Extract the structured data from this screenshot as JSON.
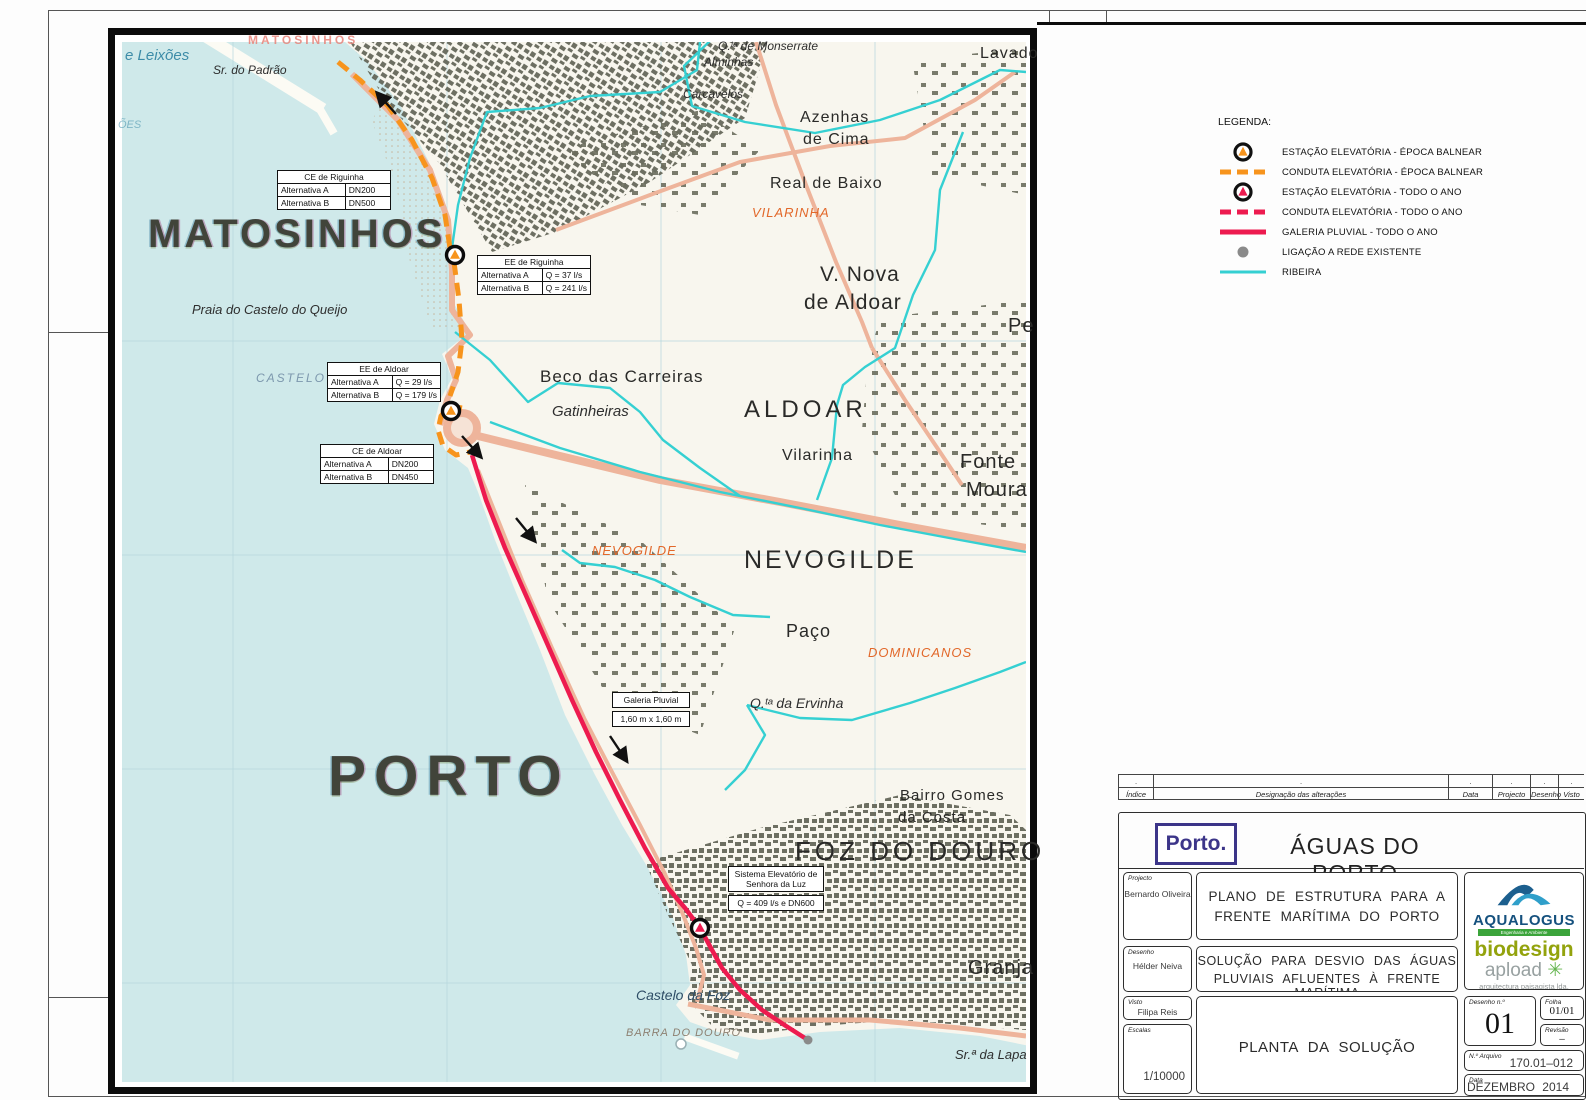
{
  "colors": {
    "orange": "#F7941D",
    "pink": "#ED1B4F",
    "cyan": "#35D0D2",
    "gray_dot": "#8A8A8A",
    "sea": "#cfe9ea",
    "land": "#f8f6ee",
    "navy_logo": "#3c3589"
  },
  "legend": {
    "title": "LEGENDA:",
    "items": [
      {
        "type": "station",
        "color": "#F7941D",
        "icon": "pump-station-seasonal",
        "label": "ESTAÇÃO ELEVATÓRIA - ÉPOCA BALNEAR"
      },
      {
        "type": "dash",
        "color": "#F7941D",
        "icon": "pressure-main-seasonal",
        "label": "CONDUTA  ELEVATÓRIA - ÉPOCA BALNEAR"
      },
      {
        "type": "station",
        "color": "#ED1B4F",
        "icon": "pump-station-allyear",
        "label": "ESTAÇÃO ELEVATÓRIA - TODO O ANO"
      },
      {
        "type": "dash",
        "color": "#ED1B4F",
        "icon": "pressure-main-allyear",
        "label": "CONDUTA  ELEVATÓRIA - TODO O ANO"
      },
      {
        "type": "solid",
        "color": "#ED1B4F",
        "icon": "storm-gallery",
        "label": "GALERIA PLUVIAL - TODO O ANO"
      },
      {
        "type": "dot",
        "color": "#8A8A8A",
        "icon": "existing-network-connection",
        "label": "LIGAÇÃO A REDE EXISTENTE"
      },
      {
        "type": "solid",
        "color": "#35D0D2",
        "icon": "stream",
        "label": "RIBEIRA"
      }
    ]
  },
  "map": {
    "labels": [
      {
        "t": "e Leixões",
        "x": 125,
        "y": 48,
        "s": 15,
        "c": "m-sea"
      },
      {
        "t": "ÕES",
        "x": 118,
        "y": 120,
        "s": 11,
        "c": "m-sea m-dim"
      },
      {
        "t": "Sr. do Padrão",
        "x": 213,
        "y": 64,
        "s": 12,
        "c": "m-it"
      },
      {
        "t": "MATOSINHOS",
        "x": 248,
        "y": 34,
        "s": 12,
        "c": "m-red"
      },
      {
        "t": "MATOSINHOS",
        "x": 148,
        "y": 214,
        "s": 40,
        "c": "m-big sp3"
      },
      {
        "t": "Praia do Castelo do Queijo",
        "x": 192,
        "y": 303,
        "s": 13,
        "c": "m-it"
      },
      {
        "t": "CASTELO",
        "x": 256,
        "y": 372,
        "s": 12,
        "c": "m-bluecaps"
      },
      {
        "t": "PORTO",
        "x": 328,
        "y": 748,
        "s": 57,
        "c": "m-big sp8"
      },
      {
        "t": "Q.ᵗᵃ de Monserrate",
        "x": 718,
        "y": 40,
        "s": 12,
        "c": "m-it"
      },
      {
        "t": "Alminhas",
        "x": 704,
        "y": 56,
        "s": 12,
        "c": "m-it"
      },
      {
        "t": "Carcavelos",
        "x": 683,
        "y": 88,
        "s": 12,
        "c": "m-it"
      },
      {
        "t": "Azenhas",
        "x": 800,
        "y": 110,
        "s": 16,
        "c": "m-town"
      },
      {
        "t": "de Cima",
        "x": 803,
        "y": 132,
        "s": 16,
        "c": "m-town"
      },
      {
        "t": "Real de Baixo",
        "x": 770,
        "y": 176,
        "s": 16,
        "c": "m-town"
      },
      {
        "t": "VILARINHA",
        "x": 752,
        "y": 206,
        "s": 13,
        "c": "m-or"
      },
      {
        "t": "Lavado",
        "x": 980,
        "y": 46,
        "s": 16,
        "c": "m-town"
      },
      {
        "t": "V. Nova",
        "x": 820,
        "y": 264,
        "s": 21,
        "c": "m-town"
      },
      {
        "t": "de Aldoar",
        "x": 804,
        "y": 292,
        "s": 21,
        "c": "m-town"
      },
      {
        "t": "Pe",
        "x": 1008,
        "y": 316,
        "s": 20,
        "c": "m-town"
      },
      {
        "t": "Beco das Carreiras",
        "x": 540,
        "y": 368,
        "s": 17,
        "c": "m-town"
      },
      {
        "t": "Gatinheiras",
        "x": 552,
        "y": 404,
        "s": 15,
        "c": "m-it"
      },
      {
        "t": "ALDOAR",
        "x": 744,
        "y": 398,
        "s": 24,
        "c": "m-town sp4"
      },
      {
        "t": "Vilarinha",
        "x": 782,
        "y": 448,
        "s": 16,
        "c": "m-town"
      },
      {
        "t": "Fonte",
        "x": 960,
        "y": 452,
        "s": 20,
        "c": "m-town"
      },
      {
        "t": "Moura",
        "x": 966,
        "y": 480,
        "s": 20,
        "c": "m-town"
      },
      {
        "t": "NEVOGILDE",
        "x": 592,
        "y": 544,
        "s": 13,
        "c": "m-or"
      },
      {
        "t": "NEVOGILDE",
        "x": 744,
        "y": 548,
        "s": 25,
        "c": "m-town sp3"
      },
      {
        "t": "Paço",
        "x": 786,
        "y": 622,
        "s": 18,
        "c": "m-town"
      },
      {
        "t": "DOMINICANOS",
        "x": 868,
        "y": 646,
        "s": 13,
        "c": "m-or"
      },
      {
        "t": "Q.ᵗᵃ da Ervinha",
        "x": 750,
        "y": 696,
        "s": 14,
        "c": "m-it"
      },
      {
        "t": "Bairro Gomes",
        "x": 900,
        "y": 788,
        "s": 15,
        "c": "m-town"
      },
      {
        "t": "da Costa",
        "x": 898,
        "y": 810,
        "s": 15,
        "c": "m-town"
      },
      {
        "t": "FOZ DO DOURO",
        "x": 795,
        "y": 838,
        "s": 26,
        "c": "m-town sp4"
      },
      {
        "t": "Granja",
        "x": 968,
        "y": 958,
        "s": 20,
        "c": "m-town"
      },
      {
        "t": "Castelo da Foz",
        "x": 636,
        "y": 988,
        "s": 14,
        "c": "m-darkblue"
      },
      {
        "t": "BARRA DO DOURO",
        "x": 626,
        "y": 1028,
        "s": 11,
        "c": "m-gray"
      },
      {
        "t": "Sr.ª da Lapa",
        "x": 955,
        "y": 1048,
        "s": 13,
        "c": "m-it"
      }
    ],
    "callouts": [
      {
        "x": 277,
        "y": 170,
        "w": 114,
        "style": "table",
        "title": "CE de Riguinha",
        "rows": [
          [
            "Alternativa A",
            "DN200"
          ],
          [
            "Alternativa B",
            "DN500"
          ]
        ]
      },
      {
        "x": 477,
        "y": 255,
        "w": 114,
        "style": "table",
        "title": "EE de Riguinha",
        "rows": [
          [
            "Alternativa A",
            "Q = 37 l/s"
          ],
          [
            "Alternativa B",
            "Q = 241 l/s"
          ]
        ]
      },
      {
        "x": 327,
        "y": 362,
        "w": 114,
        "style": "table",
        "title": "EE de Aldoar",
        "rows": [
          [
            "Alternativa A",
            "Q = 29 l/s"
          ],
          [
            "Alternativa B",
            "Q = 179 l/s"
          ]
        ]
      },
      {
        "x": 320,
        "y": 444,
        "w": 114,
        "style": "table",
        "title": "CE de Aldoar",
        "rows": [
          [
            "Alternativa A",
            "DN200"
          ],
          [
            "Alternativa B",
            "DN450"
          ]
        ]
      },
      {
        "x": 612,
        "y": 692,
        "w": 78,
        "style": "stack",
        "title": "Galeria Pluvial",
        "rows": [
          [
            "1,60 m x 1,60 m"
          ]
        ]
      },
      {
        "x": 728,
        "y": 866,
        "w": 96,
        "style": "stack",
        "title": "Sistema Elevatório de\nSenhora da Luz",
        "rows": [
          [
            "Q = 409 l/s e DN600"
          ]
        ]
      }
    ],
    "features": {
      "sea_poly": "122,42 345,42 368,62 400,105 428,160 448,215 452,260 452,300 470,332 442,354 452,378 440,400 434,424 445,450 468,468 478,492 495,540 515,590 540,650 565,715 595,775 622,825 648,868 672,915 686,955 690,985 676,1005 690,1022 718,1032 760,1040 820,1032 900,1028 980,1036 1030,1046 1030,1086 122,1086",
      "stipple_poly": "380,100 428,160 448,215 452,260 452,300 468,330 432,330 410,262 396,185 372,122",
      "piers": [
        {
          "p": "205,36 318,106",
          "w": 12
        },
        {
          "p": "318,106 332,130",
          "w": 8
        },
        {
          "p": "688,1038 735,1055",
          "w": 7
        }
      ],
      "grid_x": [
        233,
        447,
        661,
        875
      ],
      "grid_y": [
        341,
        555,
        769,
        983
      ],
      "urban": [
        {
          "pts": "350,42 768,42 745,118 650,182 556,232 492,252 438,162 384,98",
          "pat": "urbDR"
        },
        {
          "pts": "560,150 700,110 760,150 700,215 640,205 600,180",
          "pat": "urbS"
        },
        {
          "pts": "880,318 1026,300 1026,530 905,515 862,430 868,360",
          "pat": "urbS"
        },
        {
          "pts": "645,862 760,828 900,795 1010,815 1026,830 1026,1030 975,1026 900,1020 820,1026 755,1034 712,1026 688,1000 692,965 668,915",
          "pat": "urbD"
        },
        {
          "pts": "525,485 640,540 735,628 700,735 610,700 548,600",
          "pat": "urbS"
        },
        {
          "pts": "912,60 1026,48 1026,195 932,175",
          "pat": "urbS"
        }
      ],
      "roads": [
        {
          "p": "352,74 398,120 430,170 448,220 452,270 452,310 470,335 448,356 456,380 447,400 440,425",
          "w": 6
        },
        {
          "p": "478,436 560,456 660,480 780,502 900,525 1026,548",
          "w": 8
        },
        {
          "p": "688,1004 770,1020 870,1020 960,1028 1026,1036",
          "w": 5
        },
        {
          "p": "478,470 498,520 522,580 552,648 584,718 612,772 640,825 664,872 682,912 696,948 704,975 697,1002",
          "w": 4
        },
        {
          "p": "556,230 650,195 740,162 830,146 905,138 975,100 1015,72",
          "w": 4
        },
        {
          "p": "756,42 776,105 806,185 836,262 862,322 872,348",
          "w": 4
        },
        {
          "p": "872,348 905,400 940,452 962,485",
          "w": 4
        }
      ],
      "streams": [
        "700,42 697,70 660,92 590,96 540,108 487,112 470,158 458,205 452,248",
        "963,132 940,190 935,250 913,295 895,348 865,367 843,385 837,405 832,458 817,500",
        "490,422 560,448 640,472 720,492 800,508 880,525 960,540 1026,552",
        "455,332 490,360 528,402 558,383 610,388 640,412 663,440 700,468 740,496",
        "562,550 580,563 615,567 655,580 690,597 733,615 770,617",
        "747,705 765,735 745,770 725,790",
        "747,705 800,718 852,720 910,703 955,688 1000,672 1026,662",
        "713,38 684,66 692,106 745,122 815,133 880,120 940,100 1000,70 1026,72"
      ],
      "orange_lines": [
        "338,62 360,80 388,106 412,140 432,178 445,215 450,248",
        "454,262 459,300 462,340 458,372 450,396",
        "462,408 450,406 441,416 438,430 443,446 456,455 470,452"
      ],
      "red_line": "472,455 486,500 505,548 528,600 550,650 572,700 596,752 620,800 645,848 668,888 685,908 700,928 712,950 722,968 740,990 762,1010 786,1026 808,1040",
      "roundabout": {
        "x": 462,
        "y": 428,
        "r": 15
      },
      "stations": [
        {
          "x": 455,
          "y": 255,
          "color": "#F7941D"
        },
        {
          "x": 451,
          "y": 411,
          "color": "#F7941D"
        },
        {
          "x": 700,
          "y": 928,
          "color": "#ED1B4F"
        }
      ],
      "arrows": [
        {
          "x1": 396,
          "y1": 114,
          "x2": 378,
          "y2": 94
        },
        {
          "x1": 462,
          "y1": 436,
          "x2": 480,
          "y2": 456
        },
        {
          "x1": 516,
          "y1": 518,
          "x2": 534,
          "y2": 540
        },
        {
          "x1": 610,
          "y1": 736,
          "x2": 626,
          "y2": 760
        }
      ],
      "net_dots": [
        {
          "x": 808,
          "y": 1040
        }
      ]
    }
  },
  "title_block": {
    "revision": {
      "edges": [
        1118,
        1153,
        1448,
        1492,
        1530,
        1558,
        1584
      ],
      "labels": [
        "Índice",
        "Designação  das  alterações",
        "Data",
        "Projecto",
        "Desenho",
        "Visto"
      ],
      "dot": "."
    },
    "brand": {
      "logo": "Porto.",
      "company": "ÁGUAS DO PORTO"
    },
    "fields": {
      "projecto_label": "Projecto",
      "projecto": "Bernardo Oliveira",
      "desenho_label": "Desenho",
      "desenho": "Hélder Neiva",
      "visto_label": "Visto",
      "visto": "Filipa Reis",
      "escalas_label": "Escalas",
      "escala": "1/10000",
      "desenho_n_label": "Desenho  n.º",
      "desenho_n": "01",
      "folha_label": "Folha",
      "folha": "01/01",
      "revisao_label": "Revisão",
      "revisao": "–",
      "arquivo_label": "N.º Arquivo",
      "arquivo": "170.01–012",
      "data_label": "Data",
      "data": "DEZEMBRO  2014"
    },
    "titles": {
      "main1": "PLANO  DE  ESTRUTURA  PARA  A",
      "main2": "FRENTE  MARÍTIMA  DO  PORTO",
      "sub1": "SOLUÇÃO  PARA  DESVIO  DAS  ÁGUAS",
      "sub2": "PLUVIAIS  AFLUENTES  À  FRENTE  MARÍTIMA",
      "drawing": "PLANTA  DA  SOLUÇÃO"
    },
    "logos": {
      "aqualogus": "AQUALOGUS",
      "aqualogus_sub": "Engenharia e Ambiente",
      "biodesign": "biodesign",
      "apload": "apload",
      "apload_sub": "arquitectura paisagista lda."
    }
  }
}
